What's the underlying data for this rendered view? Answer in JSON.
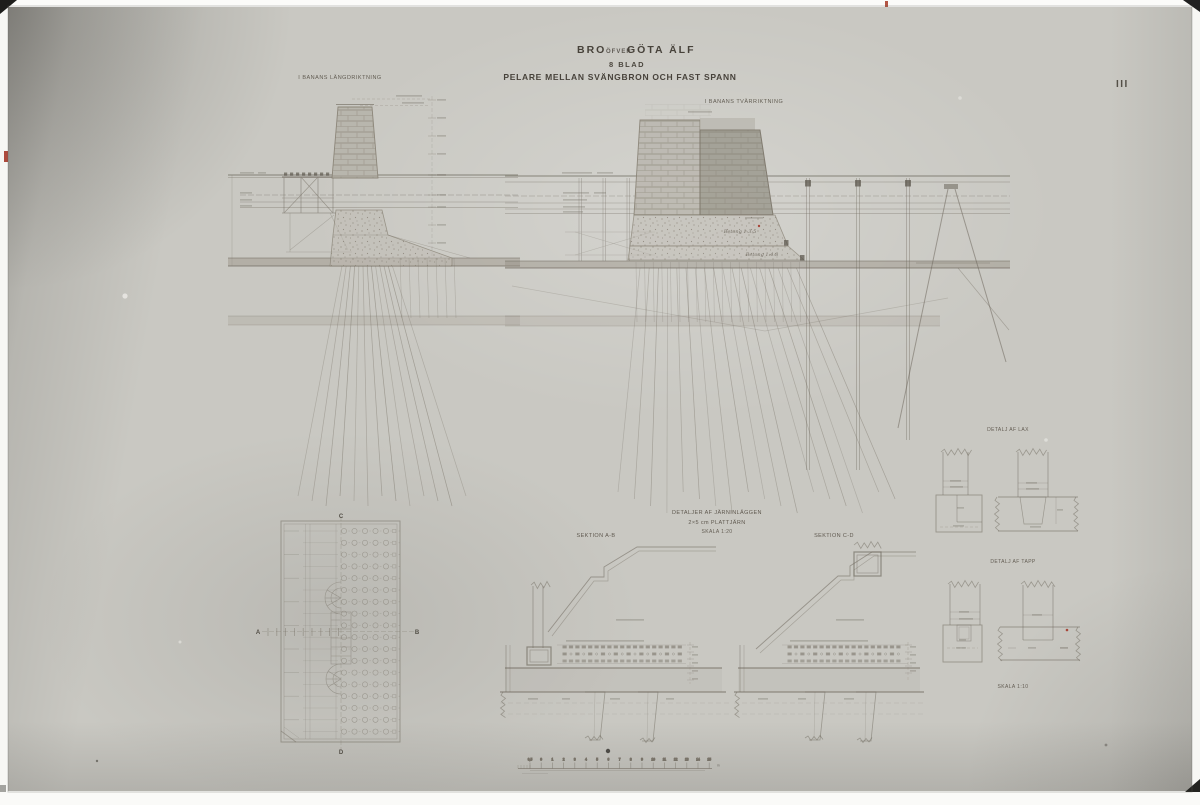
{
  "sheet": {
    "title_bro": "BRO",
    "title_ofver": "ÖFVER",
    "title_gota_alf": "GÖTA ÄLF",
    "subtitle_blad": "8 BLAD",
    "subtitle_main": "PELARE MELLAN SVÄNGBRON OCH FAST SPANN",
    "sheet_number": "III"
  },
  "views": {
    "left_elevation_label": "I BANANS LÄNGDRIKTNING",
    "middle_elevation_label": "I BANANS TVÄRRIKTNING",
    "plan_markers": {
      "a": "A",
      "b": "B",
      "c": "C",
      "d": "D"
    },
    "betong_upper": "Betong 1:3:5",
    "betong_lower": "Betong 1:4:8"
  },
  "details": {
    "jarn_caption_line1": "DETALJER AF JÄRNINLÄGGEN",
    "jarn_caption_line2": "2×5 cm PLATTJÄRN",
    "jarn_caption_line3": "SKALA 1:20",
    "sektion_ab": "SEKTION A-B",
    "sektion_cd": "SEKTION C-D",
    "detalj_lax": "DETALJ AF LAX",
    "detalj_tapp": "DETALJ AF TAPP",
    "skala_detail": "SKALA 1:10"
  },
  "scale_bar": {
    "tick_labels": [
      "0,5",
      "0",
      "1",
      "2",
      "3",
      "4",
      "5",
      "6",
      "7",
      "8",
      "9",
      "10",
      "11",
      "12",
      "13",
      "14",
      "15"
    ],
    "unit": "m"
  },
  "colors": {
    "paper": "#c9c8c2",
    "ink": "#665f53",
    "accent_red": "#a8473a"
  }
}
